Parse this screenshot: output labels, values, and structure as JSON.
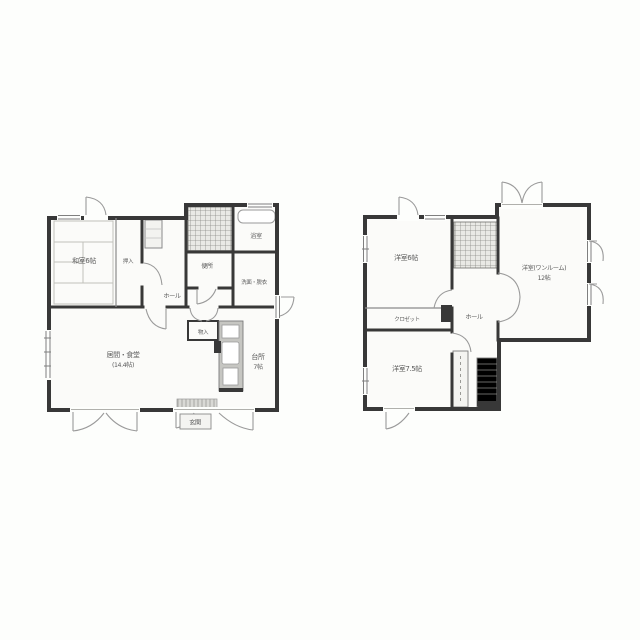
{
  "plans": {
    "floor1": {
      "rooms": {
        "washitsu": "和室6帖",
        "oshiire": "押入",
        "hall": "ホール",
        "bath": "浴室",
        "toilet": "便所",
        "washroom": "洗面・脱衣",
        "living_name": "居間・食堂",
        "living_size": "(14.4帖)",
        "kitchen_name": "台所",
        "kitchen_size": "7帖",
        "storage": "物入",
        "entrance": "玄関"
      }
    },
    "floor2": {
      "rooms": {
        "bedroom1": "洋室6帖",
        "closet": "クロゼット",
        "bedroom2": "洋室7.5帖",
        "hall": "ホール",
        "main_name": "洋室(ワンルーム)",
        "main_size": "12帖"
      }
    }
  },
  "colors": {
    "wall": "#383838",
    "thin_line": "#8a8a8a",
    "label_text": "#5c5c5c",
    "background": "#fdfefc",
    "room_fill": "#fbfbf9",
    "stairs_fill": "#e9e9e5",
    "counter_fill": "#c6c6c2"
  }
}
